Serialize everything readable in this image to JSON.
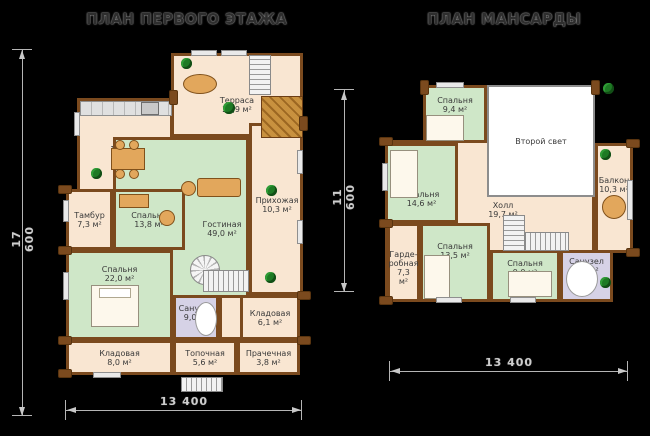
{
  "first_floor": {
    "title": "ПЛАН ПЕРВОГО ЭТАЖА",
    "dim_height": "17 600",
    "dim_width": "13 400",
    "rooms": {
      "kitchen": {
        "name": "Кухня",
        "area": "17,7 м²"
      },
      "terrace": {
        "name": "Терраса",
        "area": "29,9 м²"
      },
      "hallway": {
        "name": "Прихожая",
        "area": "10,3 м²"
      },
      "living": {
        "name": "Гостиная",
        "area": "49,0 м²"
      },
      "bedroom13": {
        "name": "Спальня",
        "area": "13,8 м²"
      },
      "tambour": {
        "name": "Тамбур",
        "area": "7,3 м²"
      },
      "bedroom22": {
        "name": "Спальня",
        "area": "22,0 м²"
      },
      "bath": {
        "name": "Санузел",
        "area": "9,0 м²"
      },
      "storage61": {
        "name": "Кладовая",
        "area": "6,1 м²"
      },
      "storage80": {
        "name": "Кладовая",
        "area": "8,0 м²"
      },
      "boiler": {
        "name": "Топочная",
        "area": "5,6 м²"
      },
      "laundry": {
        "name": "Прачечная",
        "area": "3,8 м²"
      }
    }
  },
  "attic": {
    "title": "ПЛАН МАНСАРДЫ",
    "dim_height": "11 600",
    "dim_width": "13 400",
    "rooms": {
      "bedroom94": {
        "name": "Спальня",
        "area": "9,4 м²"
      },
      "second_light": {
        "name": "Второй свет",
        "area": ""
      },
      "balcony": {
        "name": "Балкон",
        "area": "10,3 м²"
      },
      "bedroom146": {
        "name": "Спальня",
        "area": "14,6 м²"
      },
      "hall": {
        "name": "Холл",
        "area": "19,7 м²"
      },
      "wardrobe": {
        "name": "Гарде-робная",
        "area": "7,3 м²"
      },
      "bedroom135": {
        "name": "Спальня",
        "area": "13,5 м²"
      },
      "bedroom90": {
        "name": "Спальня",
        "area": "9,0 м²"
      },
      "bath": {
        "name": "Санузел",
        "area": "6,1 м²"
      }
    }
  }
}
